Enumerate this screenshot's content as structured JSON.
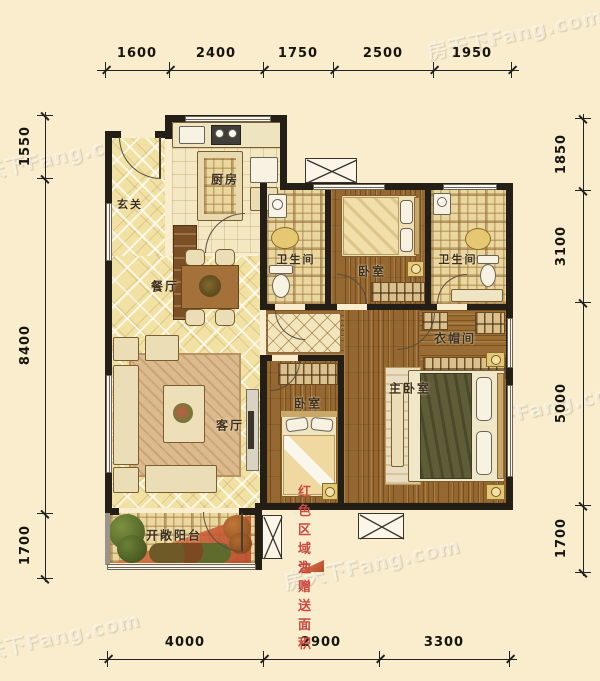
{
  "watermark": {
    "text": "房天下Fang.com"
  },
  "dimensions": {
    "top": [
      "1600",
      "2400",
      "1750",
      "2500",
      "1950"
    ],
    "bottom": [
      "4000",
      "2900",
      "3300"
    ],
    "left": [
      "1550",
      "8400",
      "1700"
    ],
    "right": [
      "1850",
      "3100",
      "5000",
      "1700"
    ]
  },
  "rooms": {
    "foyer": {
      "label": "玄关"
    },
    "kitchen": {
      "label": "厨房"
    },
    "dining": {
      "label": "餐厅"
    },
    "living": {
      "label": "客厅"
    },
    "bath1": {
      "label": "卫生间"
    },
    "bath2": {
      "label": "卫生间"
    },
    "bedroom1": {
      "label": "卧室"
    },
    "bedroom2": {
      "label": "卧室"
    },
    "master": {
      "label": "主卧室"
    },
    "closet": {
      "label": "衣帽间"
    },
    "balcony": {
      "label": "开敞阳台"
    }
  },
  "note": {
    "marker": "注",
    "text": "红色区域为赠送面积"
  },
  "colors": {
    "background": "#F9EDCE",
    "wall": "#241F16",
    "bonus_area": "#C8552F",
    "note_red": "#CB4A40"
  }
}
